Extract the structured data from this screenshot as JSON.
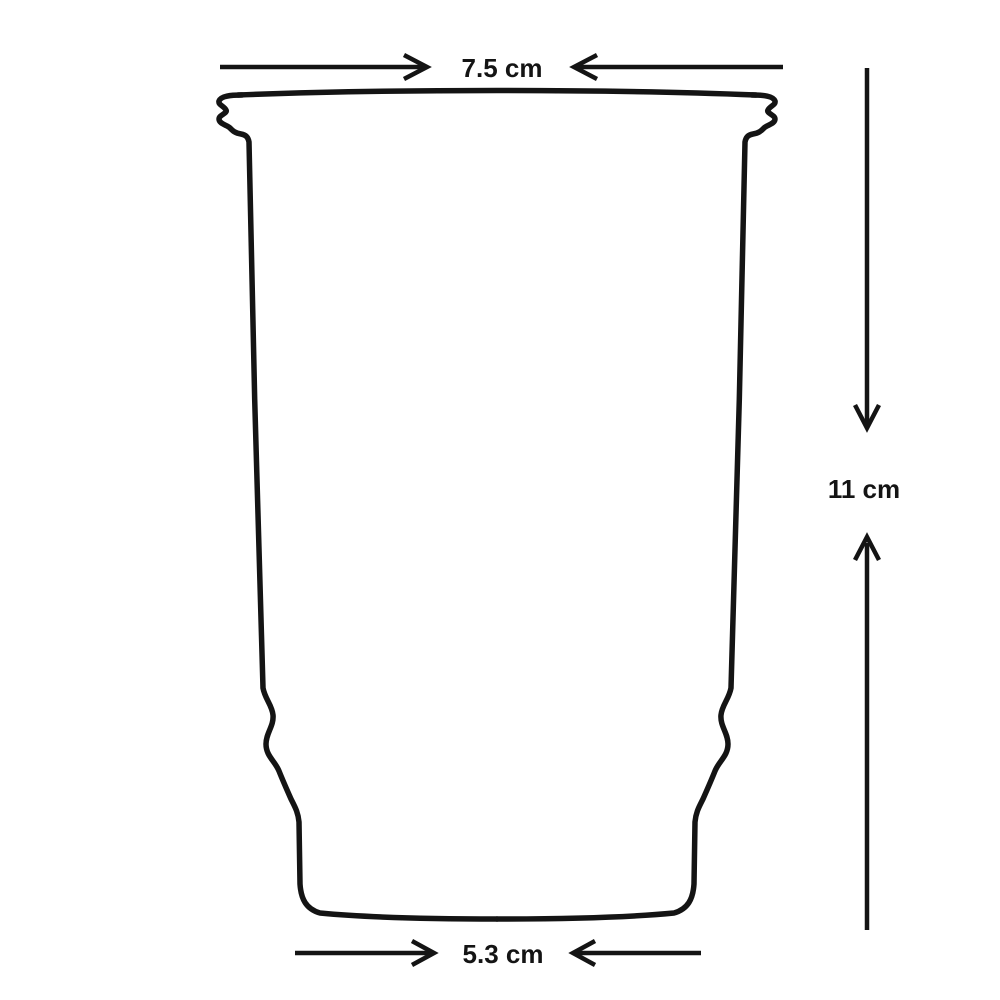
{
  "diagram": {
    "type": "technical-drawing",
    "subject": "tapered cup / tumbler outline with measurement arrows",
    "background_color": "#ffffff",
    "line_color": "#141414",
    "dimensions": {
      "top_width": {
        "label": "7.5 cm",
        "position": "top"
      },
      "height": {
        "label": "11 cm",
        "position": "right"
      },
      "bottom_width": {
        "label": "5.3 cm",
        "position": "bottom"
      }
    }
  }
}
